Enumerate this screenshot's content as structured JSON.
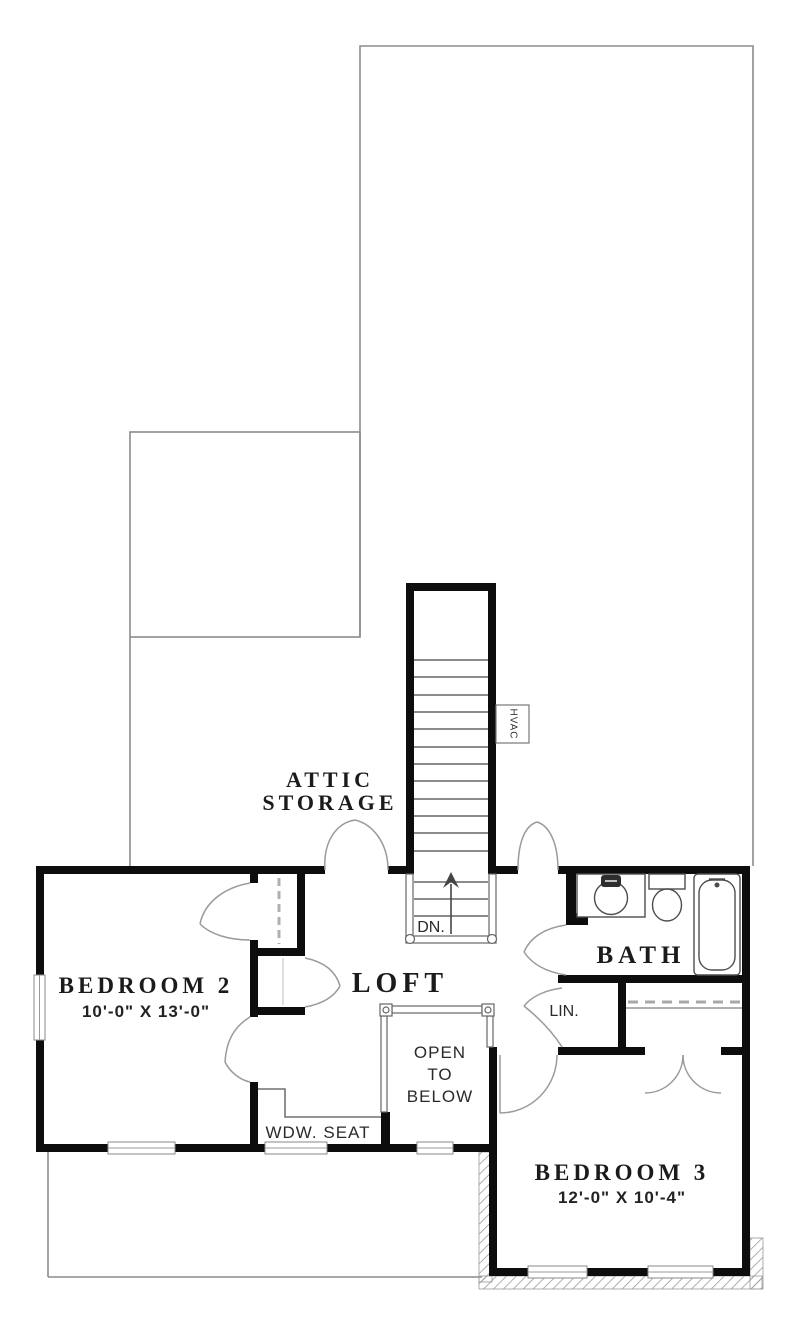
{
  "rooms": {
    "attic_storage": {
      "line1": "ATTIC",
      "line2": "STORAGE"
    },
    "loft": {
      "label": "LOFT"
    },
    "bath": {
      "label": "BATH"
    },
    "linen_closet": {
      "label": "LIN."
    },
    "bedroom_2": {
      "label": "BEDROOM 2",
      "dimensions": "10'-0\" X 13'-0\""
    },
    "bedroom_3": {
      "label": "BEDROOM 3",
      "dimensions": "12'-0\" X 10'-4\""
    },
    "open_to_below": {
      "line1": "OPEN",
      "line2": "TO",
      "line3": "BELOW"
    },
    "window_seat": {
      "label": "WDW. SEAT"
    }
  },
  "stairs": {
    "direction_label": "DN."
  },
  "equipment": {
    "hvac_label": "HVAC"
  },
  "colors": {
    "walls": "#0d0d0d",
    "first_floor_outline": "#8c8c8c",
    "door_arcs": "#9a9a9a",
    "fixtures": "#4d4d4d",
    "text": "#1b1b1b",
    "background": "#ffffff"
  }
}
